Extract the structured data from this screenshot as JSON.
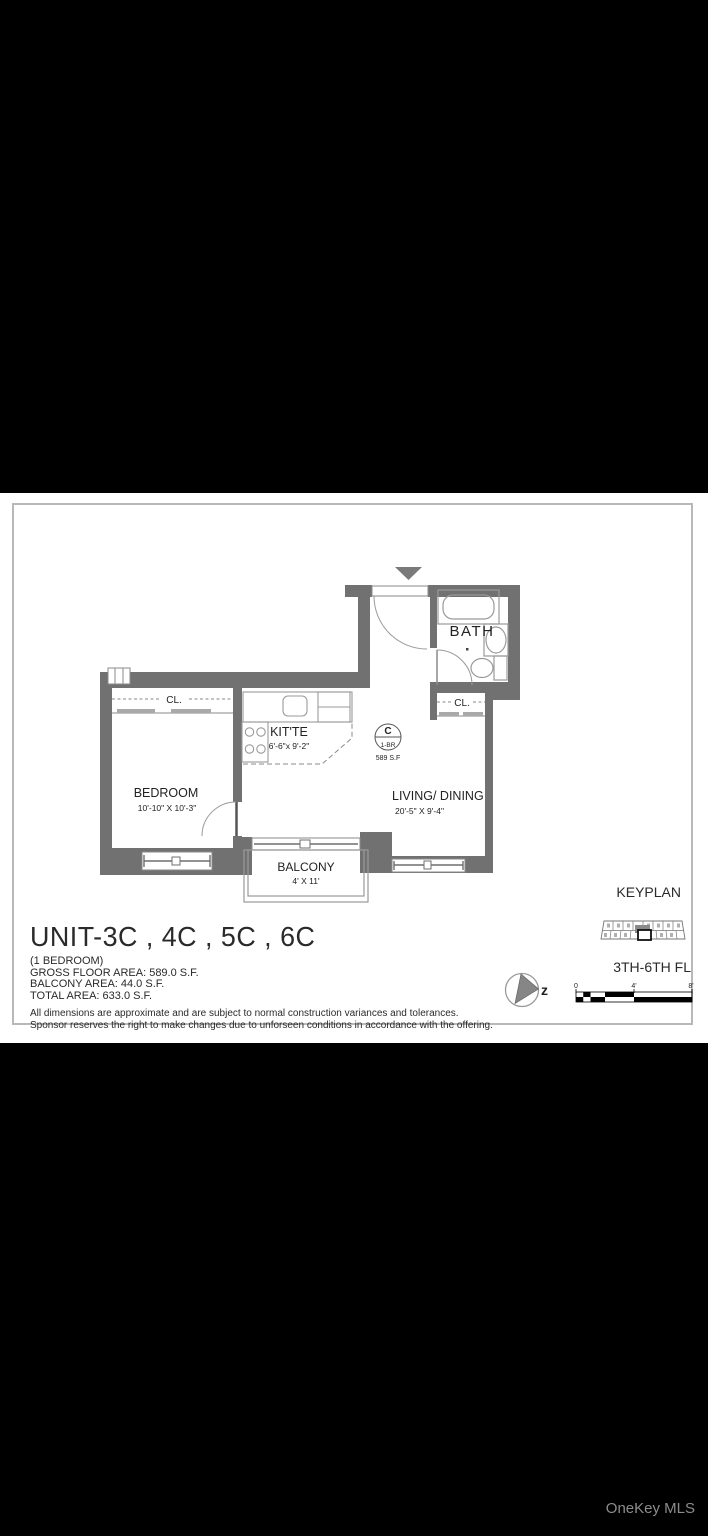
{
  "colors": {
    "wall": "#717171",
    "line": "#9a9a9a",
    "ink": "#2a2a2a",
    "border": "#b8b8b8",
    "watermark": "#8c8c8c"
  },
  "plan": {
    "rooms": {
      "bath": {
        "label": "BATH"
      },
      "bedroom": {
        "label": "BEDROOM",
        "dims": "10'-10\" X 10'-3\""
      },
      "living": {
        "label": "LIVING/ DINING",
        "dims": "20'-5\" X 9'-4\""
      },
      "kitchen": {
        "label": "KIT'TE",
        "dims": "6'-6\"x 9'-2\""
      },
      "balcony": {
        "label": "BALCONY",
        "dims": "4' X 11'"
      },
      "closet_bedroom": {
        "label": "CL."
      },
      "closet_living": {
        "label": "CL."
      }
    },
    "unit_badge": {
      "letter": "C",
      "type": "1-BR",
      "area": "589 S.F"
    }
  },
  "title_block": {
    "title": "UNIT-3C , 4C , 5C , 6C",
    "subtitle": "(1 BEDROOM)",
    "gross_area": "GROSS FLOOR AREA: 589.0 S.F.",
    "balcony_area": "BALCONY AREA: 44.0 S.F.",
    "total_area": "TOTAL AREA: 633.0 S.F.",
    "disclaimer_line1": "All dimensions are approximate and are subject to normal construction variances and tolerances.",
    "disclaimer_line2": "Sponsor reserves the right to make changes due to unforseen conditions in accordance with the offering."
  },
  "keyplan": {
    "label": "KEYPLAN",
    "floors": "3TH-6TH FL"
  },
  "scale_bar": {
    "tick0": "0",
    "tick4": "4'",
    "tick8": "8'"
  },
  "compass": {
    "letter": "z"
  },
  "watermark": "OneKey MLS"
}
